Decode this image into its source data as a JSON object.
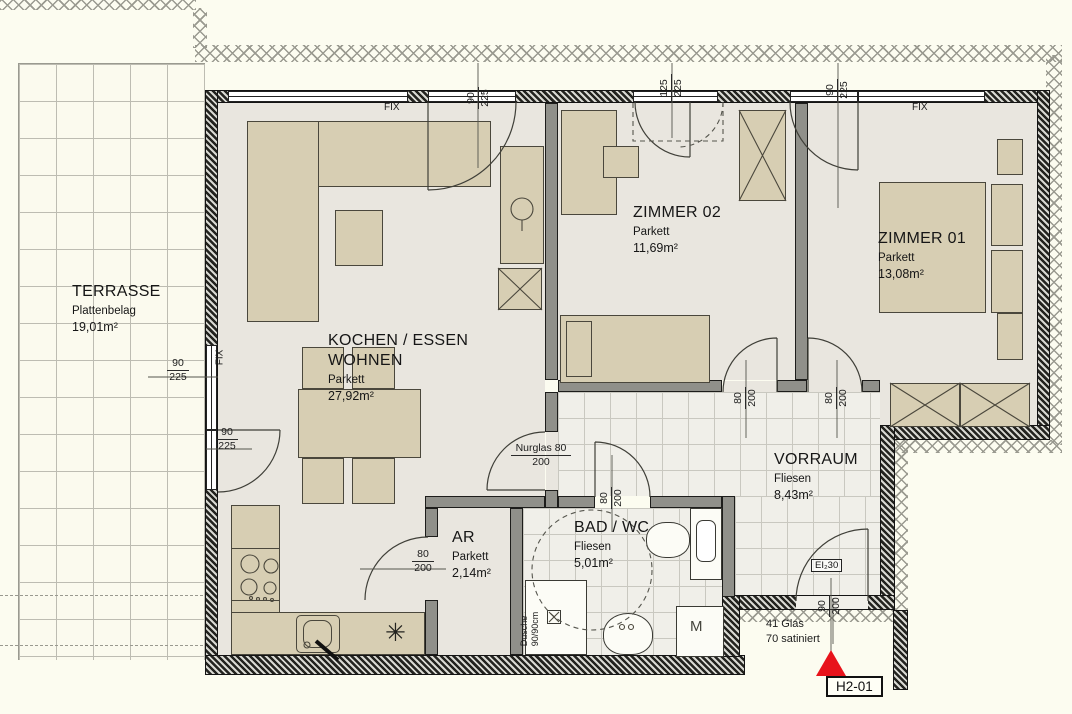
{
  "unit": {
    "tag": "H2-01"
  },
  "colors": {
    "background": "#fcfcf0",
    "floor": "#e9e6df",
    "tile_floor": "#f0efe9",
    "furniture": "#d7ceb3",
    "wall": "#1a1a1a",
    "entry_marker_red": "#e8131b"
  },
  "rooms": {
    "terrasse": {
      "name": "TERRASSE",
      "surface": "Plattenbelag",
      "area": "19,01m²"
    },
    "wohnen": {
      "name": "KOCHEN / ESSEN",
      "name2": "WOHNEN",
      "surface": "Parkett",
      "area": "27,92m²"
    },
    "zimmer02": {
      "name": "ZIMMER 02",
      "surface": "Parkett",
      "area": "11,69m²"
    },
    "zimmer01": {
      "name": "ZIMMER 01",
      "surface": "Parkett",
      "area": "13,08m²"
    },
    "vorraum": {
      "name": "VORRAUM",
      "surface": "Fliesen",
      "area": "8,43m²"
    },
    "bad": {
      "name": "BAD / WC",
      "surface": "Fliesen",
      "area": "5,01m²"
    },
    "ar": {
      "name": "AR",
      "surface": "Parkett",
      "area": "2,14m²"
    }
  },
  "dimensions": {
    "terrace_window": {
      "w": "90",
      "h": "225"
    },
    "terrace_door": {
      "w": "90",
      "h": "225"
    },
    "wohnen_glass_door": {
      "w": "90",
      "h": "225"
    },
    "zimmer02_window": {
      "w": "125",
      "h": "225"
    },
    "zimmer01_glass_door": {
      "w": "90",
      "h": "225"
    },
    "ar_door": {
      "w": "80",
      "h": "200"
    },
    "nurglas_door": {
      "label": "Nurglas",
      "w": "80",
      "h": "200"
    },
    "bad_door": {
      "w": "80",
      "h": "200"
    },
    "zimmer02_door": {
      "w": "80",
      "h": "200"
    },
    "zimmer01_door": {
      "w": "80",
      "h": "200"
    },
    "entry_door": {
      "w": "90",
      "h": "200"
    }
  },
  "annotations": {
    "fix": "FIX",
    "shower_line1": "Dusche",
    "shower_line2": "90/90cm",
    "entry_fire_rating": "EI₂30",
    "glass_note_line1": "41 Glas",
    "glass_note_line2": "70 satiniert",
    "washing_machine": "M",
    "kitchen_symbol": "✳"
  }
}
